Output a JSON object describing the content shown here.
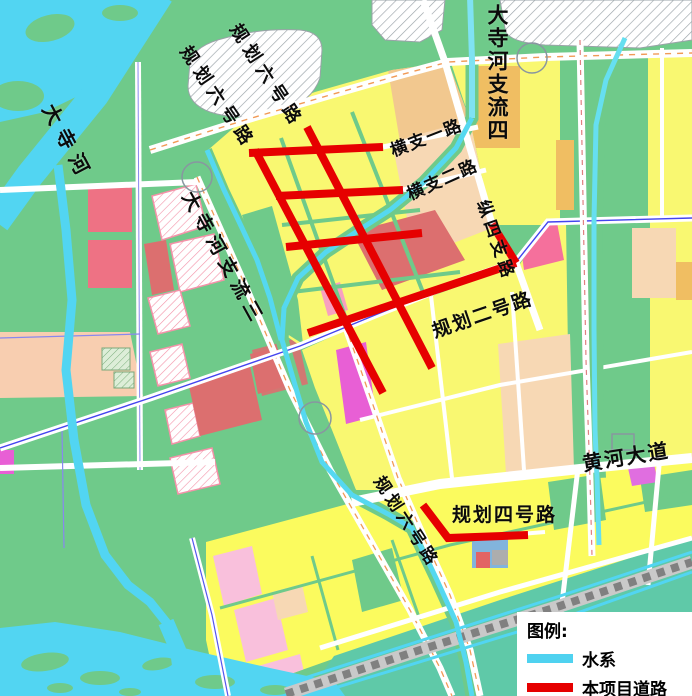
{
  "map": {
    "region_labels": {
      "dasi_river": "大寺河",
      "planned_road_6_upper_a": "规划六号路",
      "planned_road_6_upper_b": "规划六号路",
      "dasi_tributary_4": "大寺河支流四",
      "heng_branch_1": "横支一路",
      "heng_branch_2": "横支二路",
      "zong_branch_4": "纵四支路",
      "planned_road_2": "规划二号路",
      "dasi_tributary_3": "大寺河支流三",
      "huanghe_avenue": "黄河大道",
      "planned_road_4": "规划四号路",
      "planned_road_6_lower": "规划六号路"
    },
    "legend": {
      "title": "图例:",
      "items": [
        {
          "id": "water-system",
          "label": "水系",
          "color": "#4FD2F0"
        },
        {
          "id": "project-road",
          "label": "本项目道路",
          "color": "#E60000"
        }
      ]
    },
    "colors": {
      "park_green": "#6FCA8A",
      "water_cyan": "#52D5F2",
      "teal_zone": "#5FC9A8",
      "parcel_yellow": "#F9F871",
      "parcel_yellow_bright": "#FBFB5E",
      "parcel_tan": "#F2C88F",
      "parcel_orange": "#F0BE62",
      "parcel_peach": "#F7D8B4",
      "parcel_rose": "#DC6F6F",
      "parcel_rose_red": "#EE7284",
      "parcel_hot_pink": "#FB6088",
      "parcel_light_pink": "#F9C0DC",
      "parcel_pink": "#F5709C",
      "parcel_magenta": "#E85FD5",
      "project_road_red": "#E60000",
      "railway_gray": "#9E9E9E"
    }
  }
}
